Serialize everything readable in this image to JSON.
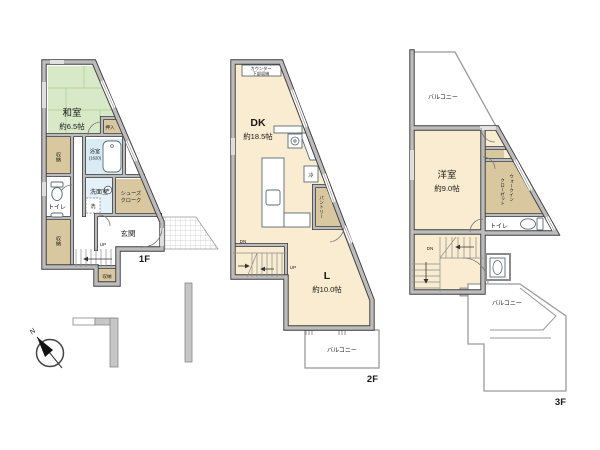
{
  "palette": {
    "tatami_green": "#d8e9c7",
    "room_cream": "#f9ecd0",
    "storage_tan": "#d9c7a0",
    "bath_blue": "#d9ecf5",
    "washroom_blue": "#e4f1f8",
    "wall_gray": "#bcbcbc"
  },
  "compass": {
    "n": "N"
  },
  "f1": {
    "floor_label": "1F",
    "washitsu": "和室",
    "washitsu_size": "約6.5帖",
    "oshiire": "押入",
    "storage_left": "収納",
    "storage_bottom_left": "収納",
    "storage_bottom": "収納",
    "bath": "浴室",
    "bath_size": "(1620)",
    "washroom": "洗面室",
    "washer": "洗",
    "toilet": "トイレ",
    "shoes_1": "シューズ",
    "shoes_2": "クローク",
    "genkan": "玄関",
    "up": "UP"
  },
  "f2": {
    "floor_label": "2F",
    "counter_1": "カウンター",
    "counter_2": "下部収納",
    "dk": "DK",
    "dk_size": "約18.5帖",
    "fridge": "冷",
    "pantry": "パントリー",
    "dn": "DN",
    "up": "UP",
    "living": "L",
    "living_size": "約10.0帖",
    "balcony": "バルコニー"
  },
  "f3": {
    "floor_label": "3F",
    "balcony_top": "バルコニー",
    "yoshitsu": "洋室",
    "yoshitsu_size": "約9.0帖",
    "wic_1": "ウォークイン",
    "wic_2": "クローゼット",
    "toilet": "トイレ",
    "dn": "DN",
    "balcony_bottom": "バルコニー"
  }
}
